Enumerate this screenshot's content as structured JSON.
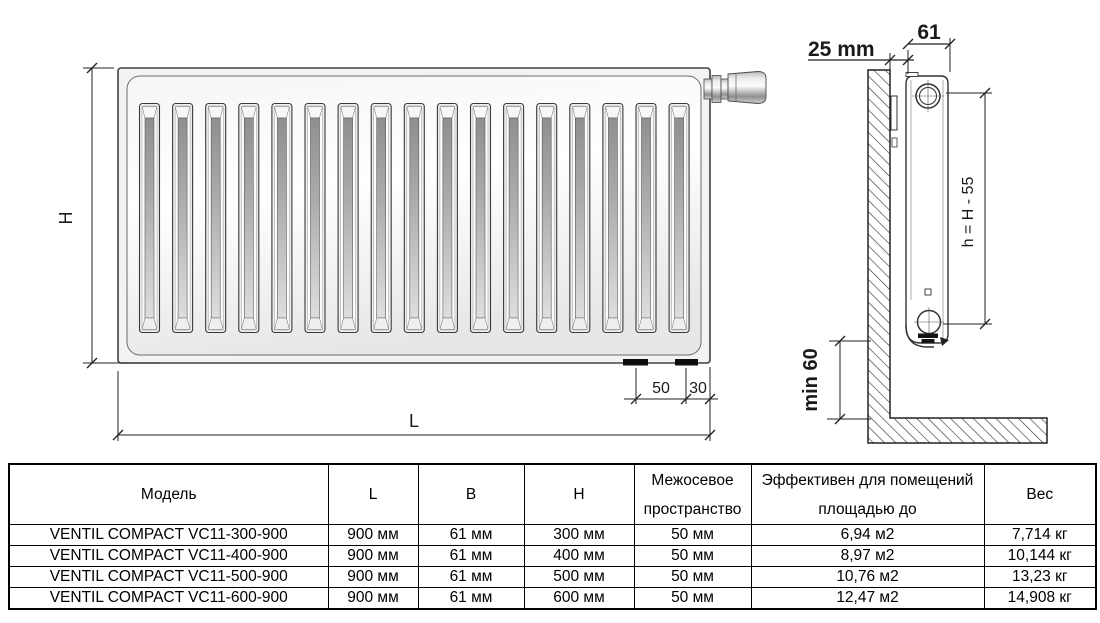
{
  "drawing": {
    "front_view": {
      "height_label": "H",
      "length_label": "L",
      "connection_spacing": "50",
      "connection_edge_offset": "30",
      "groove_count": 17
    },
    "side_view": {
      "wall_offset": "25 mm",
      "depth": "61",
      "axis_height": "h = H - 55",
      "floor_clearance": "min 60"
    }
  },
  "table": {
    "headers": [
      "Модель",
      "L",
      "B",
      "H",
      "Межосевое\nпространство",
      "Эффективен для помещений\nплощадью до",
      "Вес"
    ],
    "rows": [
      [
        "VENTIL COMPACT VC11-300-900",
        "900 мм",
        "61 мм",
        "300 мм",
        "50 мм",
        "6,94 м2",
        "7,714 кг"
      ],
      [
        "VENTIL COMPACT VC11-400-900",
        "900 мм",
        "61 мм",
        "400 мм",
        "50 мм",
        "8,97 м2",
        "10,144 кг"
      ],
      [
        "VENTIL COMPACT VC11-500-900",
        "900 мм",
        "61 мм",
        "500 мм",
        "50 мм",
        "10,76 м2",
        "13,23 кг"
      ],
      [
        "VENTIL COMPACT VC11-600-900",
        "900 мм",
        "61 мм",
        "600 мм",
        "50 мм",
        "12,47 м2",
        "14,908 кг"
      ]
    ]
  }
}
